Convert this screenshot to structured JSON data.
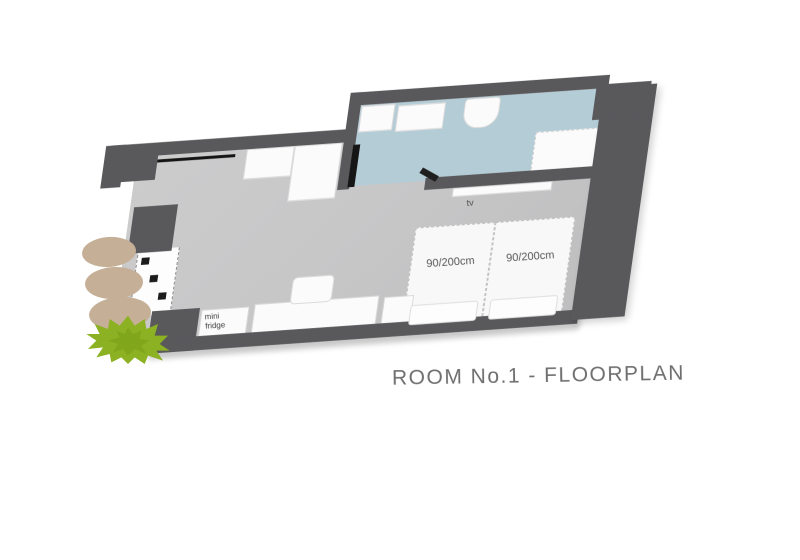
{
  "title": "ROOM No.1 - FLOORPLAN",
  "room": {
    "labels": {
      "tv": "tv",
      "mini_fridge": "mini fridge"
    },
    "beds": [
      {
        "size_label": "90/200cm"
      },
      {
        "size_label": "90/200cm"
      }
    ]
  },
  "colors": {
    "wall": "#59595c",
    "floor": "#c7c7c8",
    "bathroom_floor": "#b4ccd6",
    "furniture": "#fbfbfb",
    "accent_black": "#161616",
    "stone": "#c6af97",
    "plant": "#8cb123",
    "title_text": "#6f6f6f"
  },
  "icons": {
    "plant": "plant-icon",
    "stones": "stepping-stone"
  },
  "decor": {
    "stepping_stones_count": 3
  }
}
